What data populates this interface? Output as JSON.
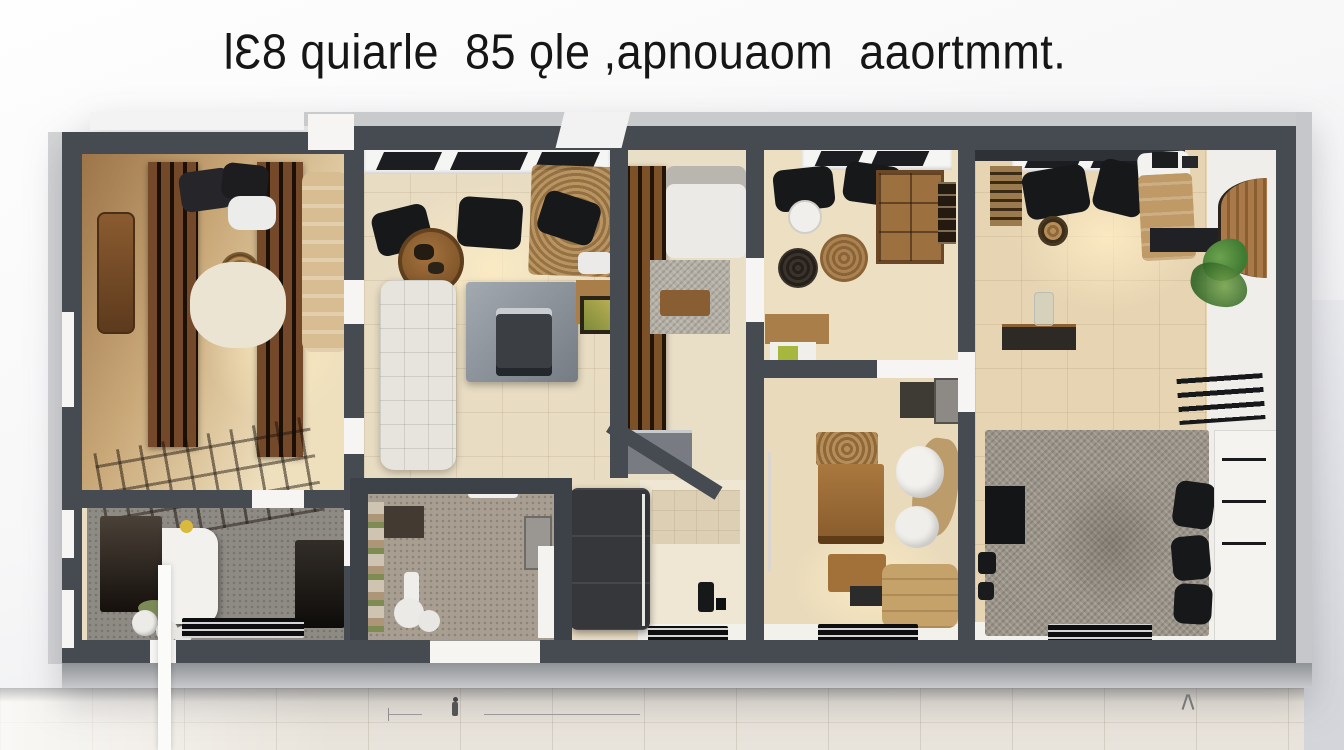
{
  "title": {
    "text": "lƐ8 quiarle  85 ǫle ,apnouaom  aaortmmt."
  },
  "scene": {
    "type": "ai-generated-floor-plan-render",
    "rooms": [
      "bedroom-left",
      "bathroom-left",
      "kitchen-dining",
      "bathroom-middle",
      "hallway-stairs",
      "shower-room",
      "study-room",
      "bedroom-middle",
      "living-bedroom-right"
    ],
    "palette": {
      "wall": "#464b52",
      "wall_dark": "#3d4248",
      "outer_band": "#c9cacc",
      "floor_tan": "#e8dcc4",
      "floor_warm": "#c9a878",
      "wood": "#8a5e33",
      "wood_dark": "#5d3a1d",
      "charcoal": "#232427",
      "rattan": "#b68d58",
      "rug_gray": "#9b9489",
      "mosaic_gray": "#8e8a84",
      "mosaic_taupe": "#a89e92",
      "white_furniture": "#f0eeea",
      "plant_green": "#4c8a3a",
      "lime_accent": "#a7b63c",
      "ground": "#e9e4db"
    }
  }
}
